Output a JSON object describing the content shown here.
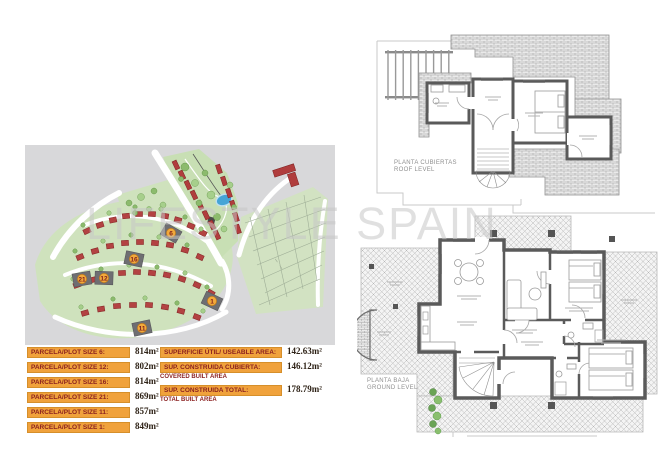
{
  "watermark": {
    "text": "LIFESTYLE SPAIN"
  },
  "site_plan": {
    "plot_markers": [
      "6",
      "16",
      "12",
      "21",
      "11",
      "1"
    ]
  },
  "plot_table": {
    "rows": [
      {
        "label": "PARCELA/PLOT SIZE 6:",
        "value": "814m²"
      },
      {
        "label": "PARCELA/PLOT SIZE 12:",
        "value": "802m²"
      },
      {
        "label": "PARCELA/PLOT SIZE 16:",
        "value": "814m²"
      },
      {
        "label": "PARCELA/PLOT SIZE 21:",
        "value": "869m²"
      },
      {
        "label": "PARCELA/PLOT SIZE 11:",
        "value": "857m²"
      },
      {
        "label": "PARCELA/PLOT SIZE 1:",
        "value": "849m²"
      }
    ]
  },
  "summary_table": {
    "rows": [
      {
        "label": "SUPERFICIE ÚTIL/ USEABLE AREA:",
        "value": "142.63m²"
      },
      {
        "label": "SUP. CONSTRUIDA CUBIERTA:",
        "sublabel": "COVERED BUILT AREA",
        "value": "146.12m²"
      },
      {
        "label": "SUP. CONSTRUIDA TOTAL:",
        "sublabel": "TOTAL BUILT AREA",
        "value": "178.79m²"
      }
    ]
  },
  "floor_plans": {
    "roof": {
      "label_es": "PLANTA CUBIERTAS",
      "label_en": "ROOF LEVEL"
    },
    "ground": {
      "label_es": "PLANTA BAJA",
      "label_en": "GROUND LEVEL"
    }
  },
  "colors": {
    "accent_orange": "#f0a23c",
    "label_red": "#8a1f1f",
    "map_gray": "#d8d8da",
    "map_green": "#cfe2bd",
    "house_red": "#b34242",
    "pool_blue": "#45a5d6",
    "plan_wall_gray": "#5a5a5a",
    "watermark_gray": "#c7c7c7"
  }
}
